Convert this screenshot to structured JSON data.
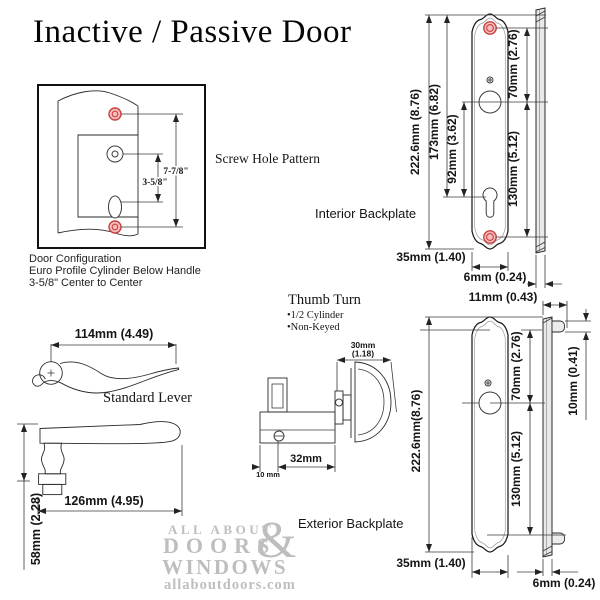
{
  "title": "Inactive / Passive Door",
  "screw_pattern": {
    "label": "Screw Hole Pattern",
    "dim_long": "7-7/8\"",
    "dim_short": "3-5/8\""
  },
  "door_config": {
    "line1": "Door Configuration",
    "line2": "Euro Profile Cylinder Below Handle",
    "line3": "3-5/8\" Center to Center"
  },
  "interior": {
    "label": "Interior Backplate",
    "height": "222.6mm (8.76)",
    "top_to_cylinder": "173mm (6.82)",
    "handle_to_cylinder": "92mm (3.62)",
    "screw_to_handle": "70mm (2.76)",
    "handle_to_screw": "130mm (5.12)",
    "width": "35mm (1.40)",
    "thickness": "6mm (0.24)"
  },
  "exterior": {
    "label": "Exterior Backplate",
    "total_thickness": "11mm (0.43)",
    "height": "222.6mm(8.76)",
    "screw_to_handle": "70mm (2.76)",
    "handle_to_screw": "130mm (5.12)",
    "boss_size": "10mm (0.41)",
    "width": "35mm (1.40)",
    "thickness": "6mm (0.24)"
  },
  "lever": {
    "label": "Standard Lever",
    "top_length": "114mm (4.49)",
    "side_length": "126mm (4.95)",
    "height": "58mm (2.28)"
  },
  "thumb_turn": {
    "title": "Thumb Turn",
    "bullet1": "•1/2 Cylinder",
    "bullet2": "•Non-Keyed",
    "knob_width_line1": "30mm",
    "knob_width_line2": "(1.18)",
    "length": "32mm",
    "offset": "10 mm"
  },
  "watermark": {
    "line1": "ALL ABOUT",
    "ampersand": "&",
    "line2": "DOORS",
    "line3": "WINDOWS",
    "line4": "allaboutdoors.com"
  },
  "colors": {
    "screw_red_stroke": "#c94040",
    "screw_red_fill": "#f6bdbd",
    "watermark_gray": "#c0bdbd",
    "line_color": "#2a2a2a"
  }
}
